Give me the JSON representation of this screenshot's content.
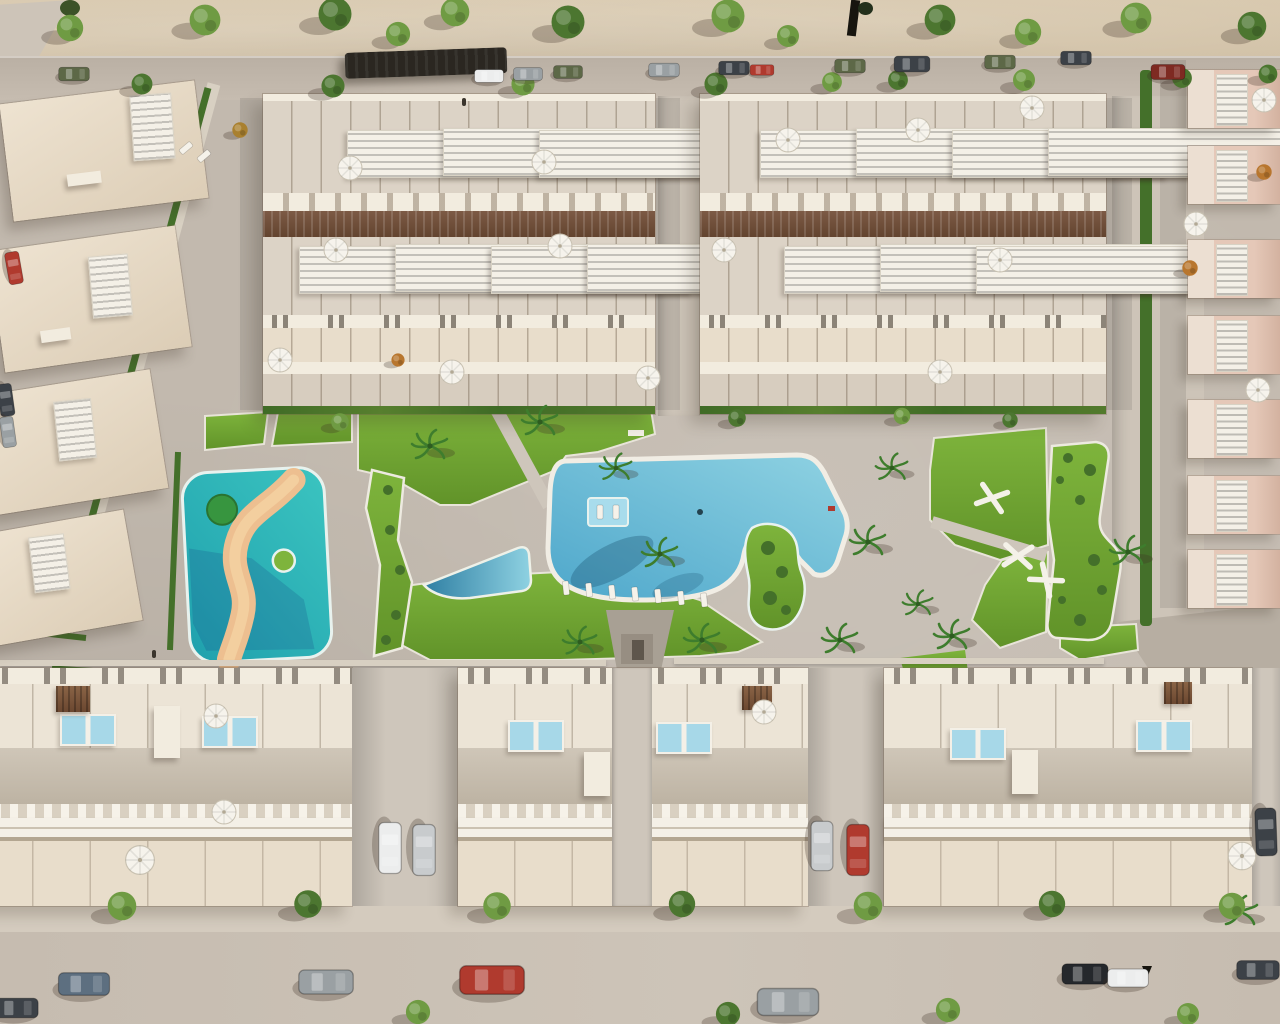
{
  "meta": {
    "description": "Aerial 3D architectural rendering of a residential development: two large blocks of back-to-back townhouses at top, rows of houses with louvered pergolas and rooftop plunge pools at bottom, side columns of houses, and a central landscaped amenity area with a large free-form pool, a triangular wading pool, a turquoise splash playground with a winding sand path, lawns, palm trees and white climbing frames. Streets with parked cars and trees surround the complex.",
    "width_px": 1280,
    "height_px": 1024,
    "visible_text": "none"
  },
  "colors": {
    "sand_top": "#d7c7ac",
    "sand_mid": "#cdbda3",
    "road": "#c6bcb0",
    "road_dark": "#bab0a4",
    "road_light": "#cdc4b8",
    "pavement": "#c2b9ae",
    "pavement_light": "#cec6bb",
    "sidewalk": "#d4cbbe",
    "lawn": "#7eb43c",
    "lawn_dark": "#619329",
    "hedge": "#44702a",
    "tree": "#6f9b43",
    "tree_dark": "#4c7630",
    "palm": "#3e7d2d",
    "pool_water": "#4ea7cb",
    "pool_light": "#8fd2e2",
    "pool_dark": "#2f7fa3",
    "pool_coping": "#f1ede4",
    "kids_pool": "#3bc4c0",
    "kids_pool_dark": "#1fa0ad",
    "sand_path": "#edbf90",
    "plunge_pool": "#a7d8e8",
    "wall_cream": "#e8ddcb",
    "wall_white": "#f2ecdf",
    "roof_terrace": "#dcd3c6",
    "roof_plain": "#cfc6b8",
    "roof_dark": "#bdb3a3",
    "building_pink": "#e5c8b8",
    "pink_dark": "#d3b2a0",
    "pergola_brown": "#7d5a45",
    "pergola_dark": "#63442f",
    "slat_white": "#f4f0e7",
    "umbrella": "#f6f3ec",
    "shadow": "rgba(60,48,35,0.28)",
    "car_red": "#b03a2e",
    "car_dark_red": "#7e2a22",
    "car_white": "#eceded",
    "car_silver": "#c8cbcd",
    "car_gray": "#9aa0a3",
    "car_dark": "#3c4147",
    "car_black": "#25282c",
    "car_olive": "#5d6847",
    "car_blue": "#5d6f80"
  },
  "scene": {
    "areas": [
      {
        "name": "top-terrain",
        "kind": "undeveloped sandy ground with scattered trees"
      },
      {
        "name": "top-road",
        "kind": "street with parallel-parked cars and street trees"
      },
      {
        "name": "townhouse-block-a",
        "kind": "back-to-back townhouse rows with roof terraces, white roof panels, umbrellas, central brown pergola band"
      },
      {
        "name": "townhouse-block-b",
        "kind": "back-to-back townhouse rows with roof terraces, white roof panels, umbrellas, central brown pergola band"
      },
      {
        "name": "left-apartment-column",
        "kind": "angled cream apartment buildings with white louvre roof panels"
      },
      {
        "name": "right-house-column",
        "kind": "column of pink-toned houses with white louvre roof panels, umbrellas and orange trees"
      },
      {
        "name": "amenity-garden",
        "kind": "central common area: lawns, palms, paths, fitness lawn with climbing frames, garden beds"
      },
      {
        "name": "main-pool",
        "kind": "large free-form swimming pool with tanning ledge, loungers and planted island"
      },
      {
        "name": "toddler-pool",
        "kind": "small triangular wading pool"
      },
      {
        "name": "splash-playground",
        "kind": "turquoise splash pool with winding sand-coloured path and palm island"
      },
      {
        "name": "bottom-house-rows",
        "kind": "three house blocks with rooftop plunge pools, louvered pergola bands and driveways with parked cars"
      },
      {
        "name": "bottom-street",
        "kind": "street with sidewalk trees and parked cars"
      }
    ],
    "counts": {
      "top_townhouse_blocks": 2,
      "bottom_house_blocks": 3,
      "right_column_units": 7,
      "rooftop_plunge_pool_pairs": 6,
      "sun_umbrellas": 21,
      "palm_trees": 13,
      "street_and_garden_trees": 33,
      "parked_cars": 23,
      "climbing_frames": 3,
      "poolside_loungers": 7
    }
  }
}
